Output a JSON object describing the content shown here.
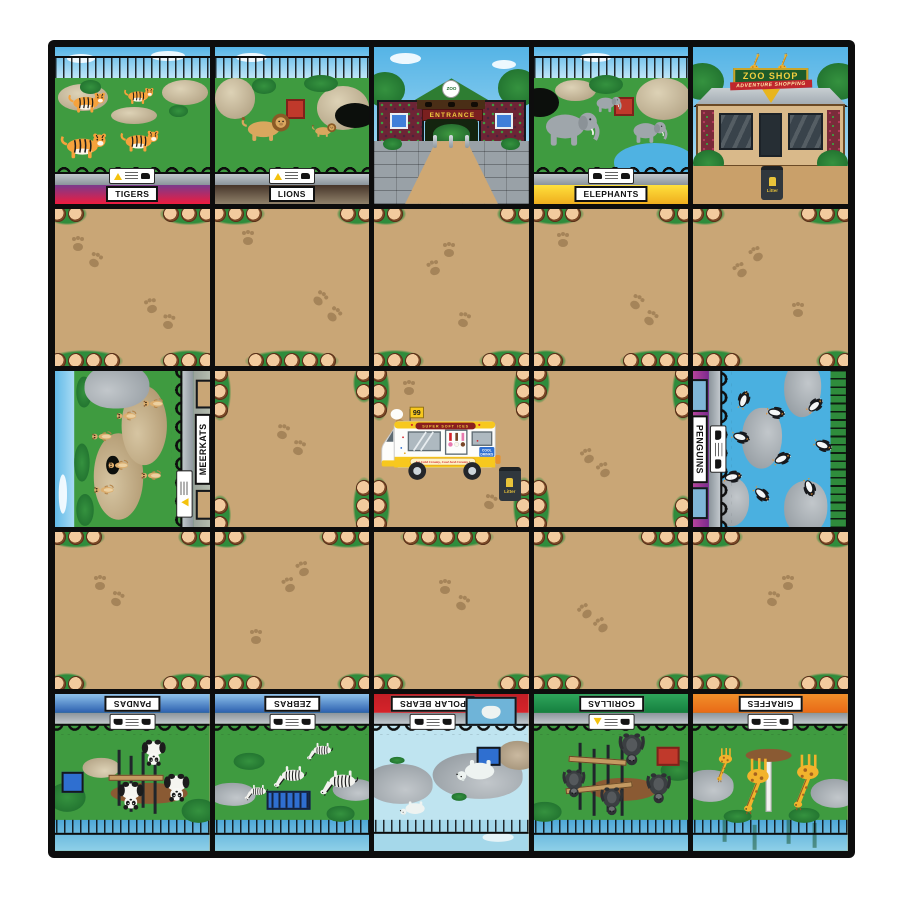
{
  "mat": {
    "background": "#ffffff",
    "grid_color": "#0d0d0d",
    "path_color": "#c9a676"
  },
  "enclosures": {
    "tigers": {
      "label": "TIGERS",
      "strip_top": "#7b3a8c",
      "strip_bottom": "#ee1c3f"
    },
    "lions": {
      "label": "LIONS",
      "strip_top": "#46352a",
      "strip_bottom": "#90816a"
    },
    "elephants": {
      "label": "ELEPHANTS",
      "strip_top": "#ffe03c",
      "strip_bottom": "#efae1e"
    },
    "meerkats": {
      "label": "MEERKATS",
      "strip_top": "#9aa39a",
      "strip_bottom": "#b9c0b2"
    },
    "penguins": {
      "label": "PENGUINS",
      "strip_top": "#7c2a8e",
      "strip_bottom": "#c2489e"
    },
    "pandas": {
      "label": "PANDAS",
      "strip_top": "#2b5fae",
      "strip_bottom": "#8fc3ec"
    },
    "zebras": {
      "label": "ZEBRAS",
      "strip_top": "#2b5fae",
      "strip_bottom": "#8fc3ec"
    },
    "polar_bears": {
      "label": "POLAR BEARS",
      "strip_top": "#d5232a",
      "strip_bottom": "#c21e25"
    },
    "gorillas": {
      "label": "GORILLAS",
      "strip_top": "#157f3f",
      "strip_bottom": "#2fa55b"
    },
    "giraffes": {
      "label": "GIRAFFES",
      "strip_top": "#e96a17",
      "strip_bottom": "#f18f2a"
    }
  },
  "entrance": {
    "logo": "ZOO",
    "sign": "ENTRANCE"
  },
  "shop": {
    "name": "ZOO SHOP",
    "tagline": "ADVENTURE SHOPPING",
    "bin": "Litter"
  },
  "van": {
    "flag": "99",
    "banner": "SUPER SOFT ICES",
    "drinks_line1": "COOL",
    "drinks_line2": "DRINKS",
    "slogan": "Ice Cold Creamy, Cool Iced Creamy !",
    "bin": "Litter"
  }
}
